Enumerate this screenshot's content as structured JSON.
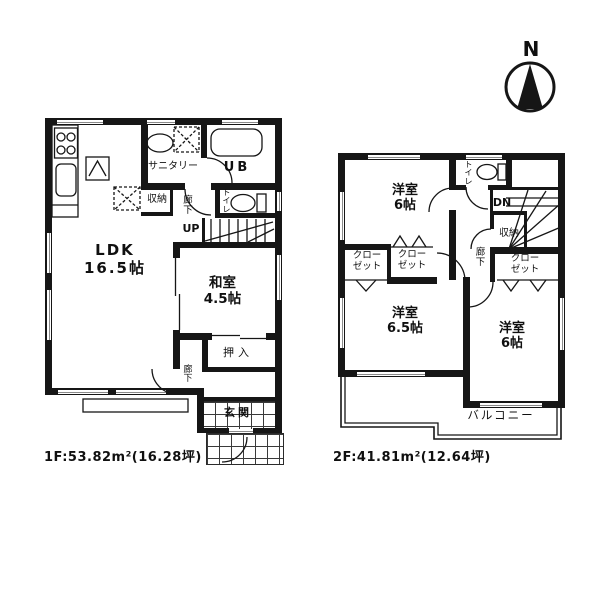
{
  "compass": {
    "north_label": "N"
  },
  "floor1": {
    "caption": "1F:53.82m²(16.28坪)",
    "rooms": {
      "ldk": "LDK\n16.5帖",
      "washitsu": "和室\n4.5帖",
      "sanitary": "サニタリー",
      "unit_bath": "UB",
      "storage": "収納",
      "hallway": "廊\n下",
      "stairs_up": "UP",
      "toilet": "ト\nイ\nレ",
      "oshiire": "押入",
      "hallway_lower": "廊\n下",
      "entrance": "玄関"
    }
  },
  "floor2": {
    "caption": "2F:41.81m²(12.64坪)",
    "rooms": {
      "bedroom_north": "洋室\n6帖",
      "toilet": "ト\nイ\nレ",
      "stairs_down": "DN",
      "storage": "収納",
      "closet_west": "クロー\nゼット",
      "closet_center": "クロー\nゼット",
      "closet_east": "クロー\nゼット",
      "hallway": "廊\n下",
      "bedroom_southwest": "洋室\n6.5帖",
      "bedroom_southeast": "洋室\n6帖",
      "balcony": "バルコニー"
    }
  },
  "colors": {
    "line": "#161616",
    "background": "#ffffff"
  }
}
